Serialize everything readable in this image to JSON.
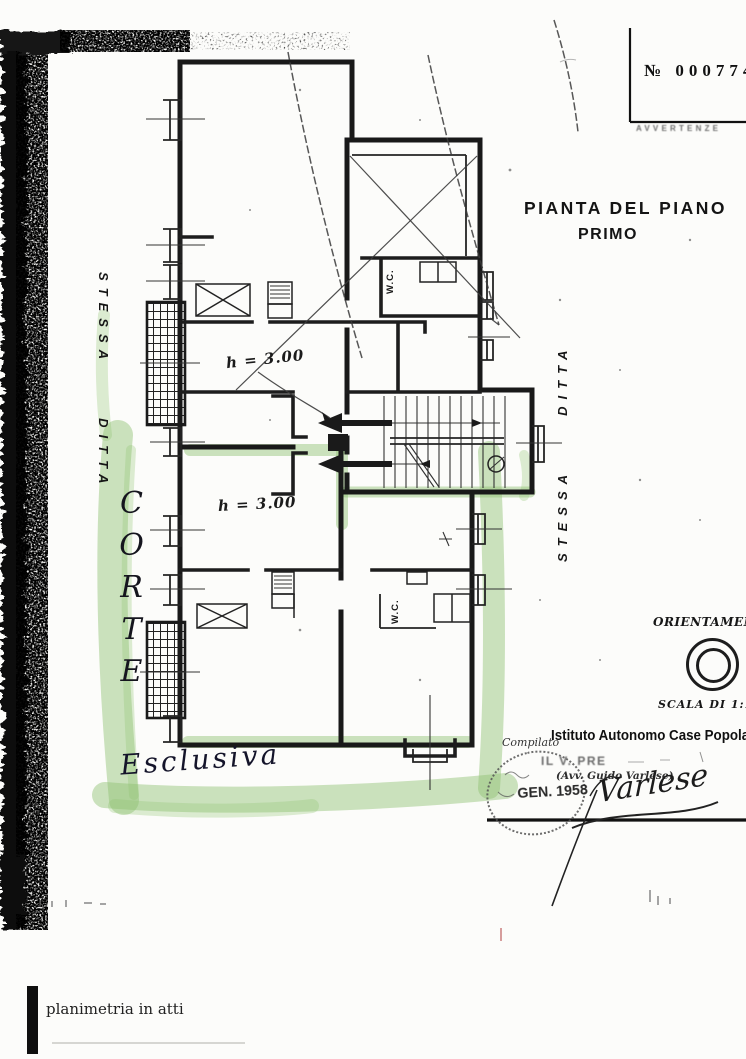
{
  "document": {
    "number_label": "№",
    "number": "0007746",
    "notice": "AVVERTENZE",
    "title": "PIANTA DEL PIANO",
    "subtitle": "PRIMO",
    "footer_note": "planimetria in atti"
  },
  "plan": {
    "left_margin_label": "STESSA DITTA",
    "right_margin_label": "STESSA DITTA",
    "upper_height_label": "h = 3.00",
    "lower_height_label": "h = 3.00",
    "upper_wc_label": "W.C.",
    "lower_wc_label": "W.C."
  },
  "highlights": {
    "corte": "CORTE",
    "esclusiva": "Esclusiva",
    "marker_color": "#8fc272"
  },
  "orientation": {
    "label": "ORIENTAMENTO",
    "scale": "SCALA DI 1:100"
  },
  "approval": {
    "compiled_label": "Compilato",
    "institute": "Istituto Autonomo Case Popolari",
    "role": "IL V. PRE",
    "delegate": "(Avv. Guido Varlese)",
    "stamp_date": "GEN. 1958",
    "signature": "Varlese"
  }
}
